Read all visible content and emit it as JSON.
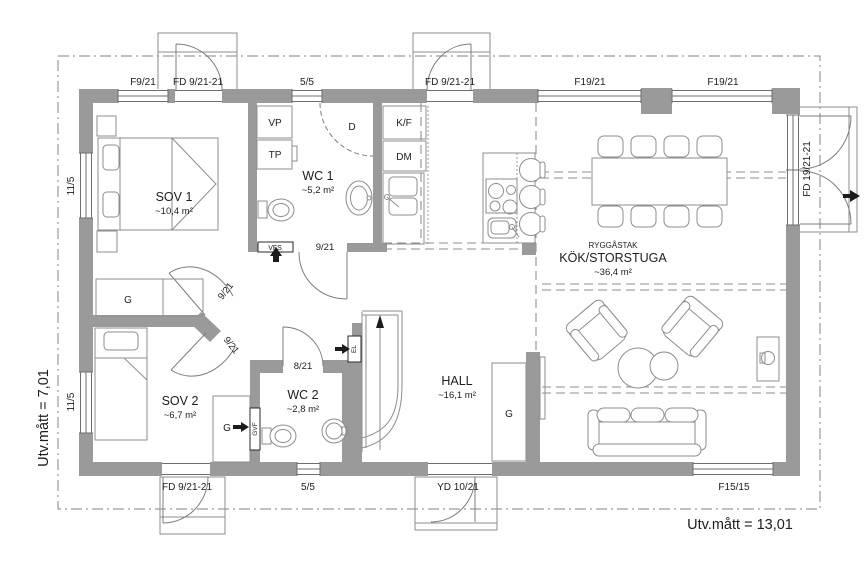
{
  "plan": {
    "dims": {
      "left": "Utv.mått = 7,01",
      "bottom": "Utv.mått = 13,01"
    },
    "rooms": {
      "sov1": {
        "name": "SOV 1",
        "area": "~10,4 m²"
      },
      "wc1": {
        "name": "WC 1",
        "area": "~5,2 m²"
      },
      "sov2": {
        "name": "SOV 2",
        "area": "~6,7 m²"
      },
      "wc2": {
        "name": "WC 2",
        "area": "~2,8 m²"
      },
      "hall": {
        "name": "HALL",
        "area": "~16,1 m²"
      },
      "kok": {
        "note": "RYGGÅSTAK",
        "name": "KÖK/STORSTUGA",
        "area": "~36,4 m²"
      }
    },
    "openings": {
      "top_f921": "F9/21",
      "top_fd1": "FD 9/21-21",
      "top_55": "5/5",
      "top_fd2": "FD 9/21-21",
      "top_f1921a": "F19/21",
      "top_f1921b": "F19/21",
      "right_fd": "FD 19/21-21",
      "left_115a": "11/5",
      "left_115b": "11/5",
      "bottom_fd": "FD 9/21-21",
      "bottom_55": "5/5",
      "bottom_yd": "YD 10/21",
      "bottom_f1515": "F15/15"
    },
    "doors": {
      "wc1": "9/21",
      "sov1": "9/21",
      "sov2": "9/21",
      "wc2": "8/21"
    },
    "fixtures": {
      "vp": "VP",
      "tp": "TP",
      "shower": "D",
      "fridge": "K/F",
      "dishwasher": "DM",
      "vfs": "VFS",
      "el": "EL",
      "gvf": "GVF",
      "g_sov1": "G",
      "g_sov2": "G",
      "g_hall": "G"
    },
    "colors": {
      "wall_fill": "#9a9a9a",
      "line": "#7d7d7d",
      "text": "#1c1c1c",
      "background": "#ffffff"
    }
  }
}
